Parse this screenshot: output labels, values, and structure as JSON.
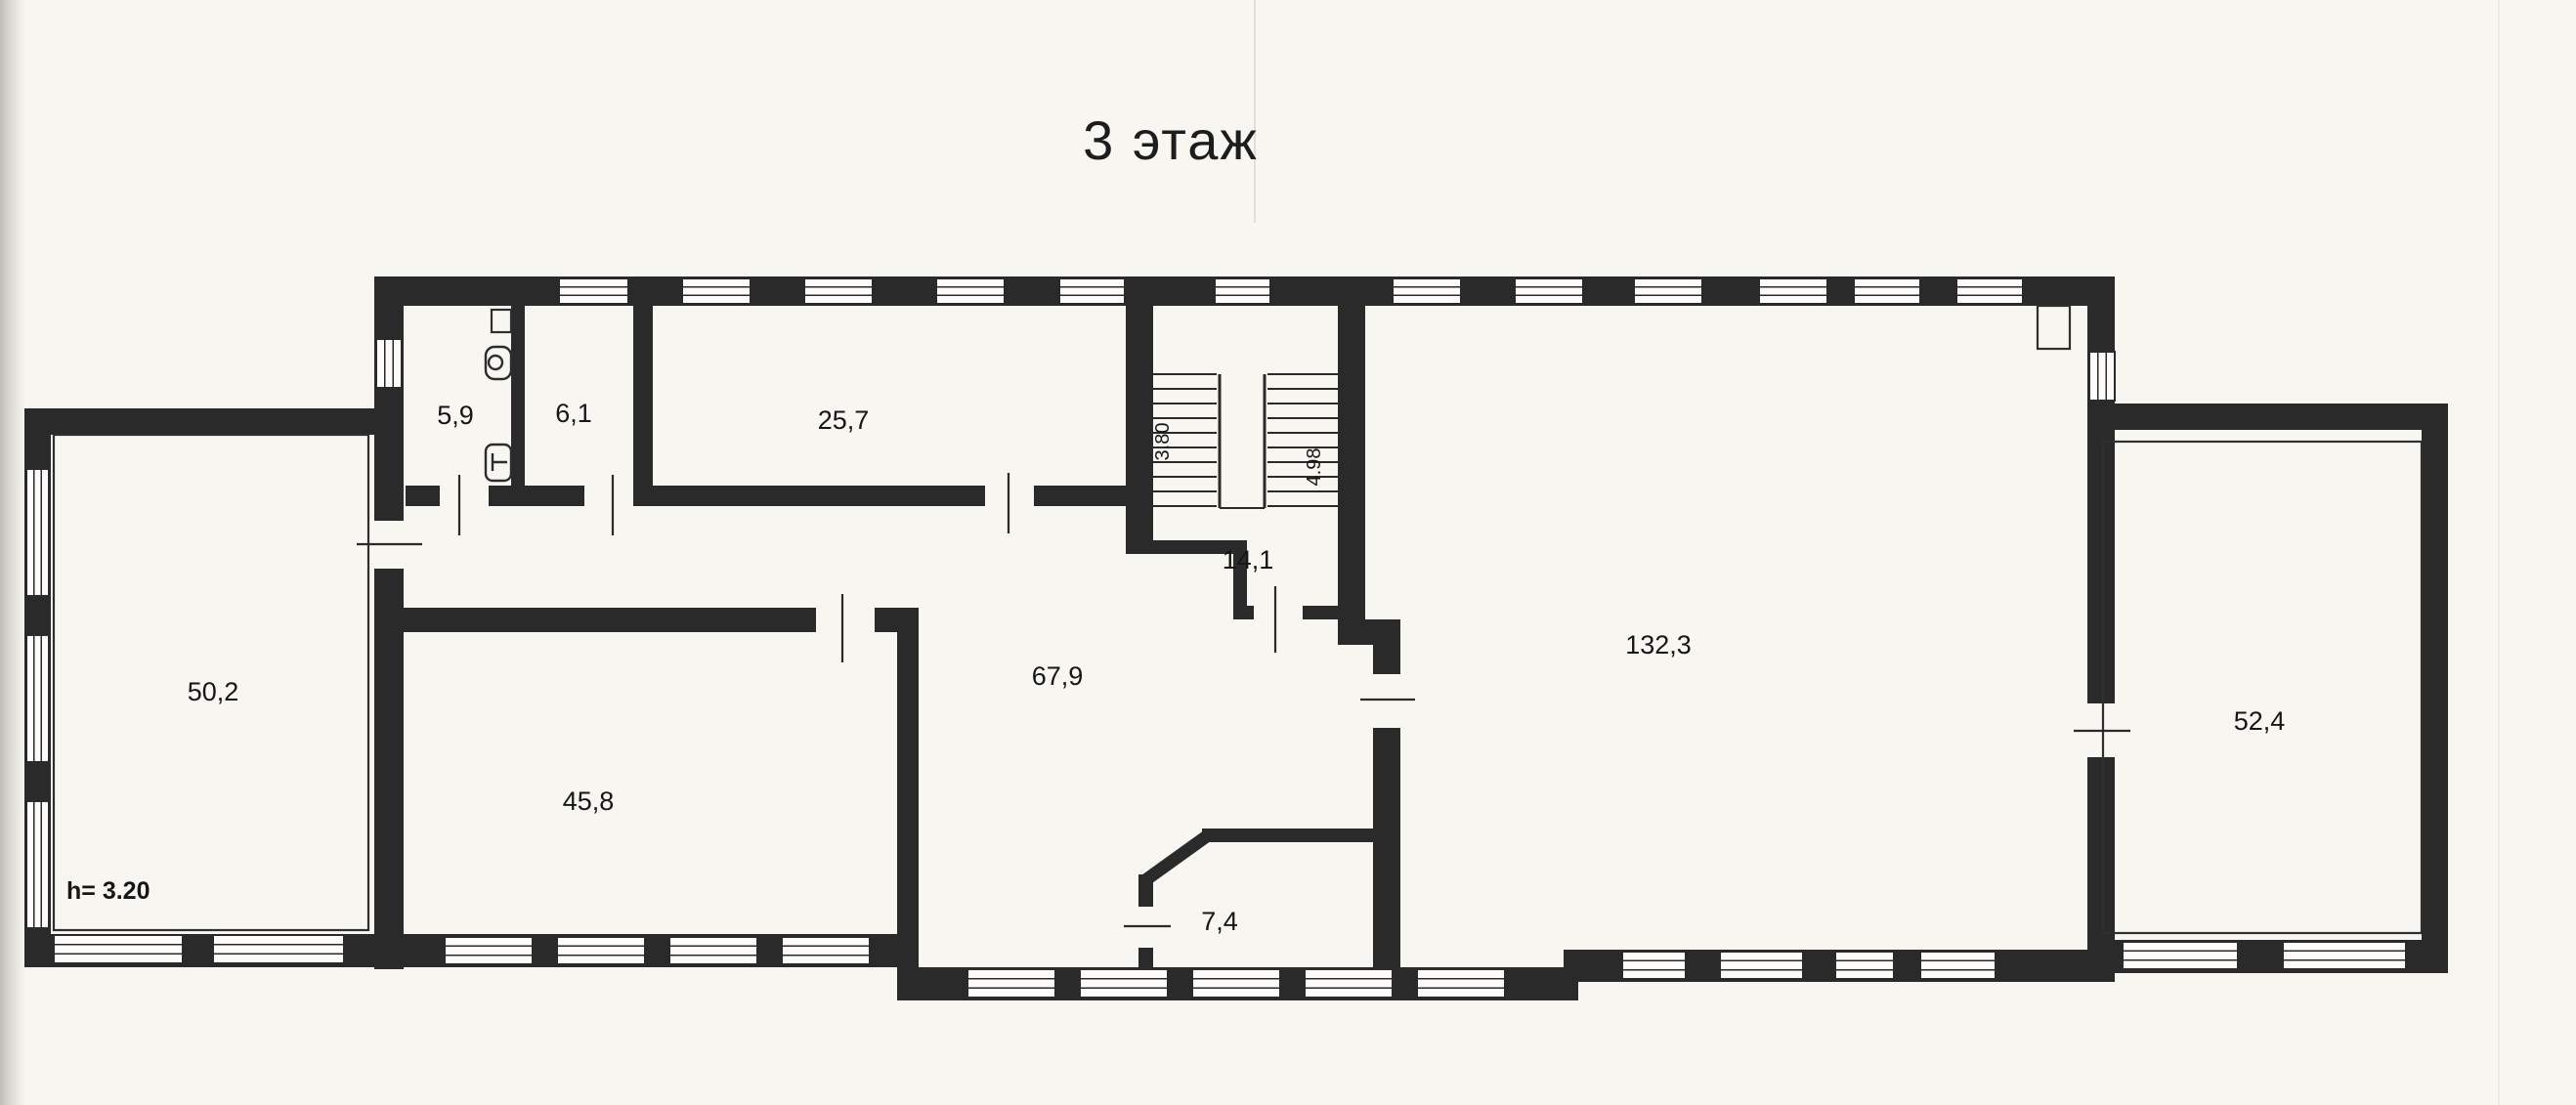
{
  "page": {
    "title": "3 этаж"
  },
  "rooms": [
    {
      "name": "wc",
      "area": "5,9"
    },
    {
      "name": "room-6-1",
      "area": "6,1"
    },
    {
      "name": "room-25-7",
      "area": "25,7"
    },
    {
      "name": "room-50-2",
      "area": "50,2"
    },
    {
      "name": "room-45-8",
      "area": "45,8"
    },
    {
      "name": "room-67-9",
      "area": "67,9"
    },
    {
      "name": "hall-14-1",
      "area": "14,1"
    },
    {
      "name": "room-7-4",
      "area": "7,4"
    },
    {
      "name": "room-132-3",
      "area": "132,3"
    },
    {
      "name": "room-52-4",
      "area": "52,4"
    }
  ],
  "stairs": {
    "dim_left": "3.80",
    "dim_right": "4.98"
  },
  "annotations": {
    "ceiling_height": "h= 3.20"
  },
  "colors": {
    "ink": "#2a2a2a",
    "paper": "#f8f6f1"
  }
}
